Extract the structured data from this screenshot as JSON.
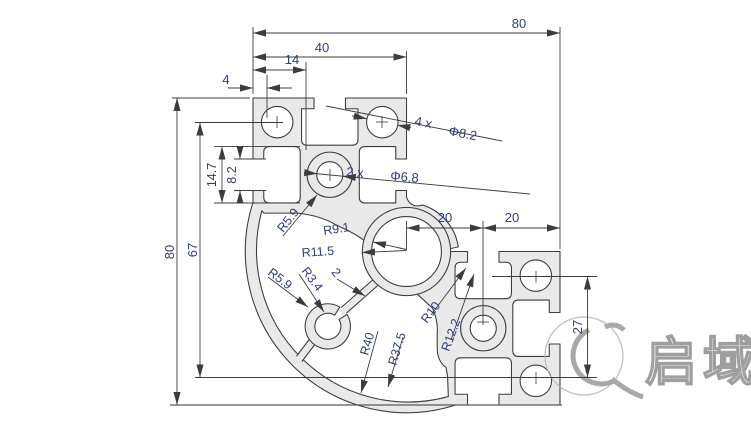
{
  "drawing": {
    "dims": {
      "overall_width": "80",
      "upper_width": "40",
      "offset_14": "14",
      "lip_4": "4",
      "overall_height": "80",
      "height_67": "67",
      "slot_cavity_14_7": "14.7",
      "slot_opening_8_2": "8.2",
      "mid_20_left": "20",
      "mid_20_right": "20",
      "right_27": "27"
    },
    "labels": {
      "corner_holes_qty": "4 x",
      "corner_holes_dia": "Φ8.2",
      "center_holes_qty": "2 x",
      "center_holes_dia": "Φ6.8",
      "r_center_hole": "R9.1",
      "r_center_boss": "R11.5",
      "r_boss_upper": "R5.9",
      "r_boss_lower": "R5.9",
      "r_small_hole": "R3.4",
      "rib_thickness": "2",
      "r_pocket_10": "R10",
      "r_pocket_12_2": "R12.2",
      "r_arc_outer": "R40",
      "r_arc_inner": "R37.5"
    },
    "colors": {
      "profile_fill": "#e9e9e9",
      "line": "#3c3c3c",
      "dim_text": "#2e3c80",
      "logo_gray": "#8f8f8f"
    },
    "logo": {
      "text": "启域"
    }
  }
}
